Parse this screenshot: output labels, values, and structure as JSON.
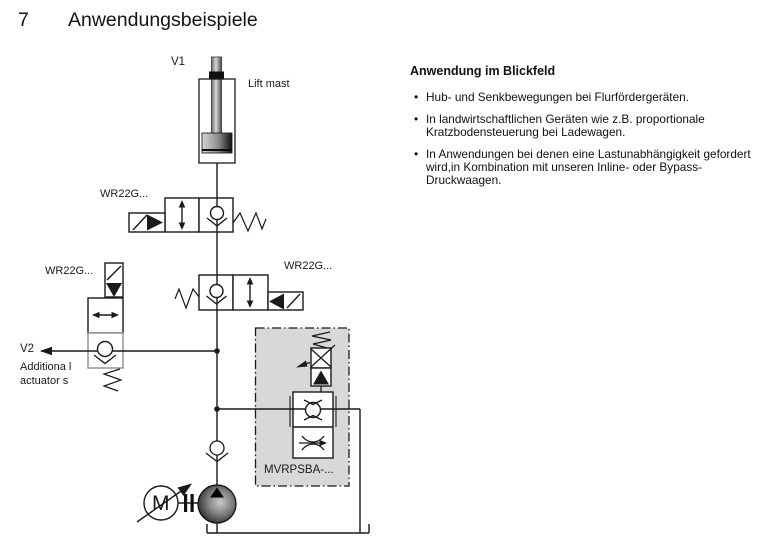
{
  "page": {
    "section_number": "7",
    "section_title": "Anwendungsbeispiele"
  },
  "diagram": {
    "labels": {
      "cylinder": "V1",
      "cylinder_desc": "Lift mast",
      "valve_top": "WR22G...",
      "valve_left": "WR22G...",
      "valve_mid": "WR22G...",
      "port_v2": "V2",
      "additional_line1": "Additiona l",
      "additional_line2": "actuator s",
      "cartridge": "MVRPSBA-...",
      "motor": "M"
    },
    "colors": {
      "line": "#1a1a1a",
      "cartridge_box_fill": "#d7d9d8",
      "pump_dark": "#0d0d0d",
      "pump_light": "#c9c9c9"
    }
  },
  "info": {
    "heading": "Anwendung im Blickfeld",
    "bullets": [
      "Hub- und Senkbewegungen bei Flurfördergeräten.",
      "In landwirtschaftlichen Geräten wie z.B. proportionale Kratzbodensteuerung bei Ladewagen.",
      "In Anwendungen bei denen eine Lastunabhängigkeit gefordert wird,in Kombination mit unseren Inline- oder Bypass-Druckwaagen."
    ],
    "bullet_char": "•"
  }
}
